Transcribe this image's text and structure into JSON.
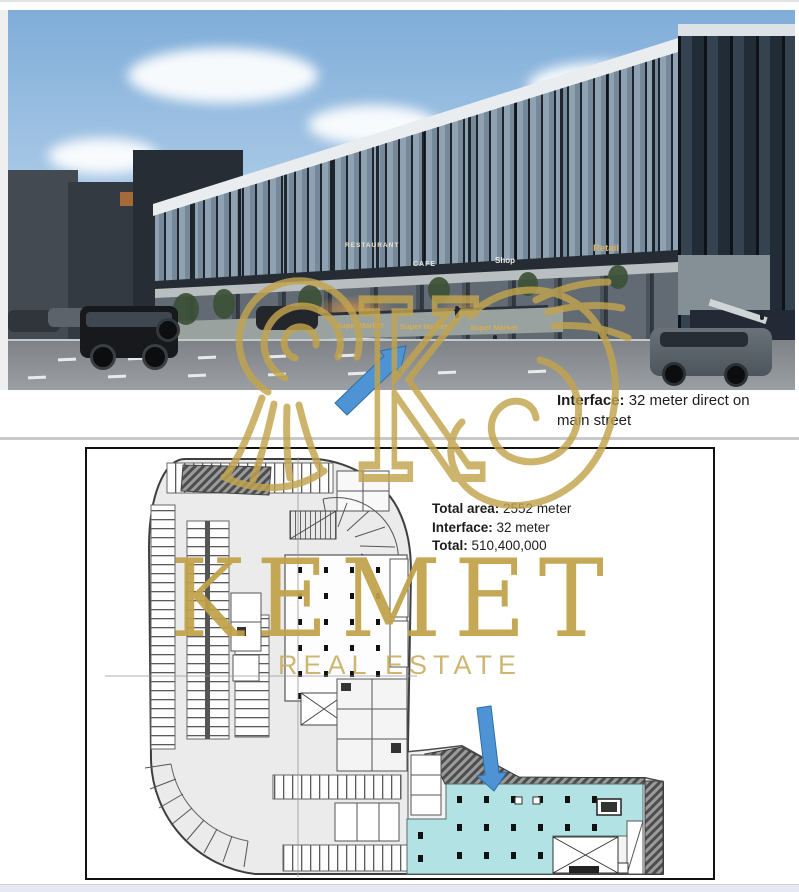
{
  "photo": {
    "description": "Exterior render of a three-storey glass commercial strip mall on a main street",
    "signs": {
      "restaurant": "RESTAURANT",
      "cafe": "CAFE",
      "shop": "Shop",
      "retail": "Retail",
      "super_market_1": "Super Market",
      "super_market_2": "Super Market",
      "super_market_3": "Super Market"
    }
  },
  "watermark": {
    "brand": "KEMET",
    "tagline": "REAL ESTATE"
  },
  "notes": {
    "street_interface": {
      "label": "Interface:",
      "line1_rest": " 32 meter direct on",
      "line2": "main street"
    },
    "plan": {
      "total_area_label": "Total area:",
      "total_area_value": " 2552 meter",
      "interface_label": "Interface:",
      "interface_value": " 32 meter",
      "total_label": "Total:",
      "total_value": " 510,400,000"
    }
  },
  "colors": {
    "watermark_gold": "#C2A44E",
    "highlight_teal": "#B2E2E4",
    "arrow_blue": "#4E94D4"
  }
}
